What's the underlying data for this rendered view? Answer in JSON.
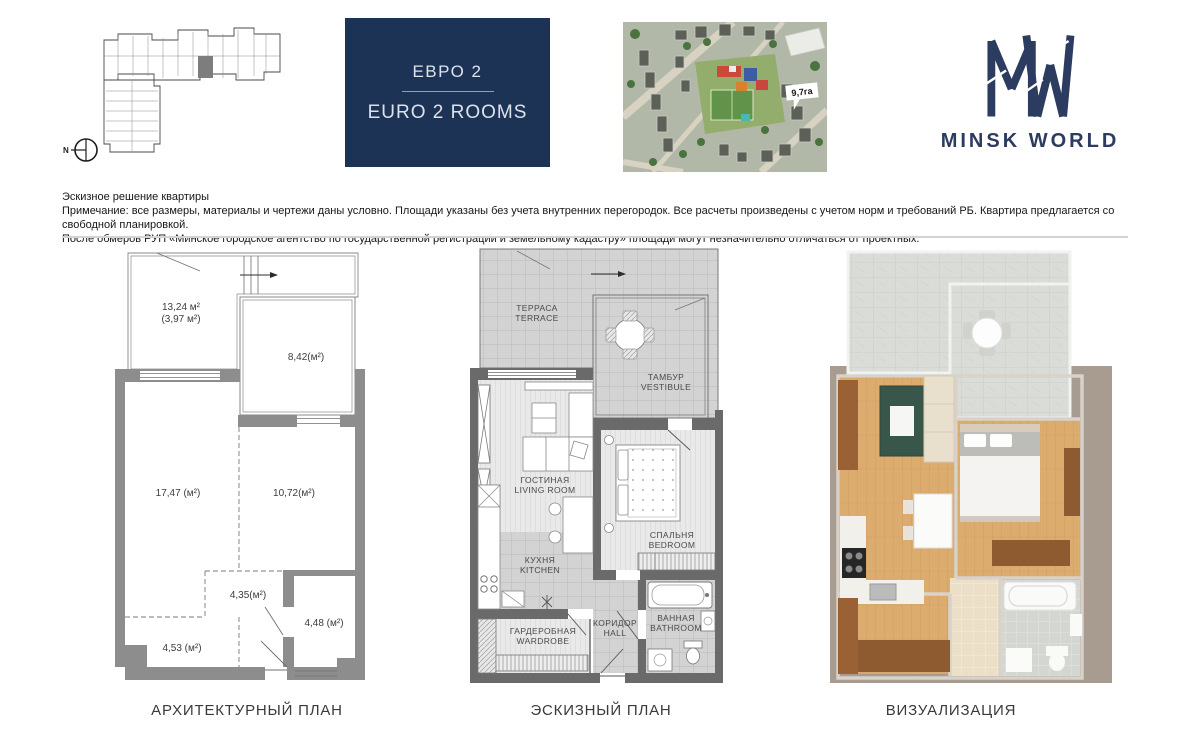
{
  "header": {
    "compass": "N",
    "unit_card": {
      "title_ru": "ЕВРО 2",
      "title_en": "EURO 2 ROOMS"
    },
    "aerial": {
      "area_tag": "9,7га"
    },
    "logo": {
      "brand": "MINSK WORLD"
    }
  },
  "disclaimer": {
    "line1": "Эскизное решение квартиры",
    "line2": "Примечание: все размеры, материалы и чертежи даны условно. Площади указаны без учета внутренних перегородок. Все расчеты произведены с учетом норм и требований РБ. Квартира предлагается со свободной планировкой.",
    "line3": "После обмеров РУП «Минское городское агентство по государственной регистрации и земельному кадастру» площади могут незначительно отличаться от проектных."
  },
  "architectural_plan": {
    "caption": "АРХИТЕКТУРНЫЙ ПЛАН",
    "areas": {
      "terrace_total": "13,24 м²",
      "terrace_reduced": "(3,97 м²)",
      "glazed_room": "8,42(м²)",
      "living_room": "17,47 (м²)",
      "bedroom": "10,72(м²)",
      "hall": "4,35(м²)",
      "bathroom": "4,48 (м²)",
      "wardrobe": "4,53 (м²)"
    }
  },
  "sketch_plan": {
    "caption": "ЭСКИЗНЫЙ ПЛАН",
    "rooms": {
      "terrace": {
        "ru": "ТЕРРАСА",
        "en": "TERRACE"
      },
      "vestibule": {
        "ru": "ТАМБУР",
        "en": "VESTIBULE"
      },
      "living": {
        "ru": "ГОСТИНАЯ",
        "en": "LIVING ROOM"
      },
      "kitchen": {
        "ru": "КУХНЯ",
        "en": "KITCHEN"
      },
      "bedroom": {
        "ru": "СПАЛЬНЯ",
        "en": "BEDROOM"
      },
      "wardrobe": {
        "ru": "ГАРДЕРОБНАЯ",
        "en": "WARDROBE"
      },
      "hall": {
        "ru": "КОРИДОР",
        "en": "HALL"
      },
      "bathroom": {
        "ru": "ВАННАЯ",
        "en": "BATHROOM"
      }
    }
  },
  "visualization": {
    "caption": "ВИЗУАЛИЗАЦИЯ"
  },
  "colors": {
    "brand_navy": "#1d3356",
    "arch_wall_gray": "#8d8d8d",
    "sketch_wall_gray": "#6a6a6a",
    "wood": "#dcab6e",
    "taupe_background": "#a89b8f"
  }
}
